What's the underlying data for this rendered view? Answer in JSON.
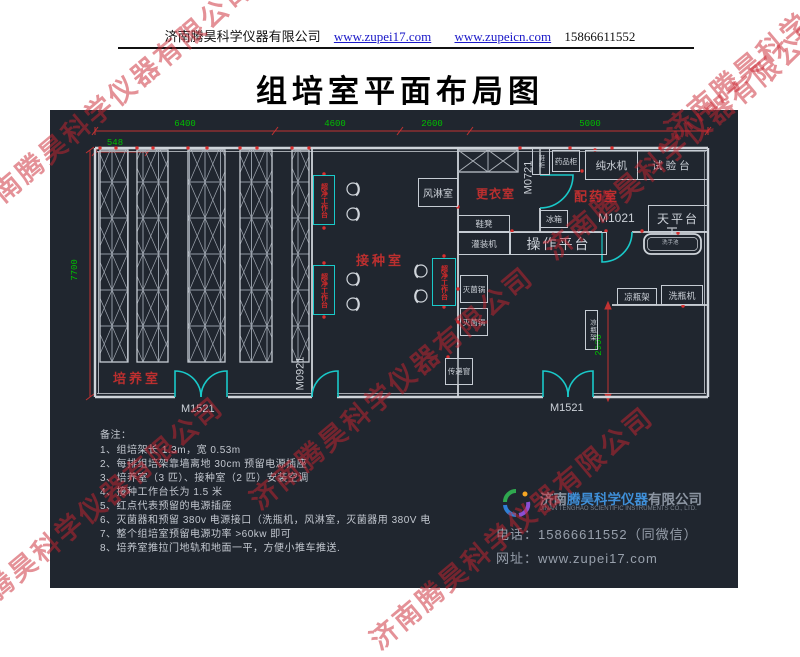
{
  "header": {
    "company": "济南腾昊科学仪器有限公司",
    "link1": "www.zupei17.com",
    "link2": "www.zupeicn.com",
    "phone": "15866611552"
  },
  "title": "组培室平面布局图",
  "watermark": "济南腾昊科学仪器有限公司",
  "plan": {
    "dims": {
      "d6400": "6400",
      "d4600": "4600",
      "d2600": "2600",
      "d5000": "5000",
      "d548": "548",
      "d7700": "7700",
      "d2900": "2900"
    },
    "rooms": {
      "culture": "培养室",
      "inoculation": "接种室",
      "changing": "更衣室",
      "dispensing": "配药室"
    },
    "doors": {
      "m1521": "M1521",
      "m0921": "M0921",
      "m0721": "M0721",
      "m1021": "M1021"
    },
    "equip": {
      "air_shower": "风淋室",
      "clean_bench": "超净工作台",
      "shoe_cabinet": "鞋柜",
      "medicine_cabinet": "药品柜",
      "water_purifier": "纯水机",
      "test_bench": "试验台",
      "fridge": "冰箱",
      "shoe_stool": "鞋凳",
      "filling_machine": "灌装机",
      "operation_platform": "操作平台",
      "balance_table": "天平台",
      "hand_sink": "洗手池",
      "sterilizer": "灭菌锅",
      "pass_window": "传递窗",
      "bottle_rack": "凉瓶架",
      "bottle_washer": "洗瓶机"
    }
  },
  "notes": {
    "label": "备注：",
    "items": [
      "1、组培架长 1.3m，宽 0.53m",
      "2、每排组培架靠墙离地 30cm 预留电源插座",
      "3、培养室（3 匹）、接种室（2 匹）安装空调",
      "4、接种工作台长为 1.5 米",
      "5、红点代表预留的电源插座",
      "6、灭菌器和预留 380v 电源接口（洗瓶机，风淋室，灭菌器用 380V 电",
      "7、整个组培室预留电源功率 >60kw 即可",
      "8、培养室推拉门地轨和地面一平，方便小推车推送."
    ]
  },
  "footer": {
    "brand_prefix": "济南",
    "brand_name": "腾昊科学仪器",
    "brand_suffix": "有限公司",
    "brand_en": "JINAN TENGHAO SCIENTIFIC INSTRUMENTS CO., LTD.",
    "phone": "电话：15866611552（同微信）",
    "website": "网址：www.zupei17.com"
  },
  "colors": {
    "canvas_bg": "#20262f",
    "dim_text": "#00bf00",
    "dim_line": "#c23232",
    "room_label": "#bb2f2f",
    "door": "#19c9c9",
    "wall": "#cfd4da"
  }
}
